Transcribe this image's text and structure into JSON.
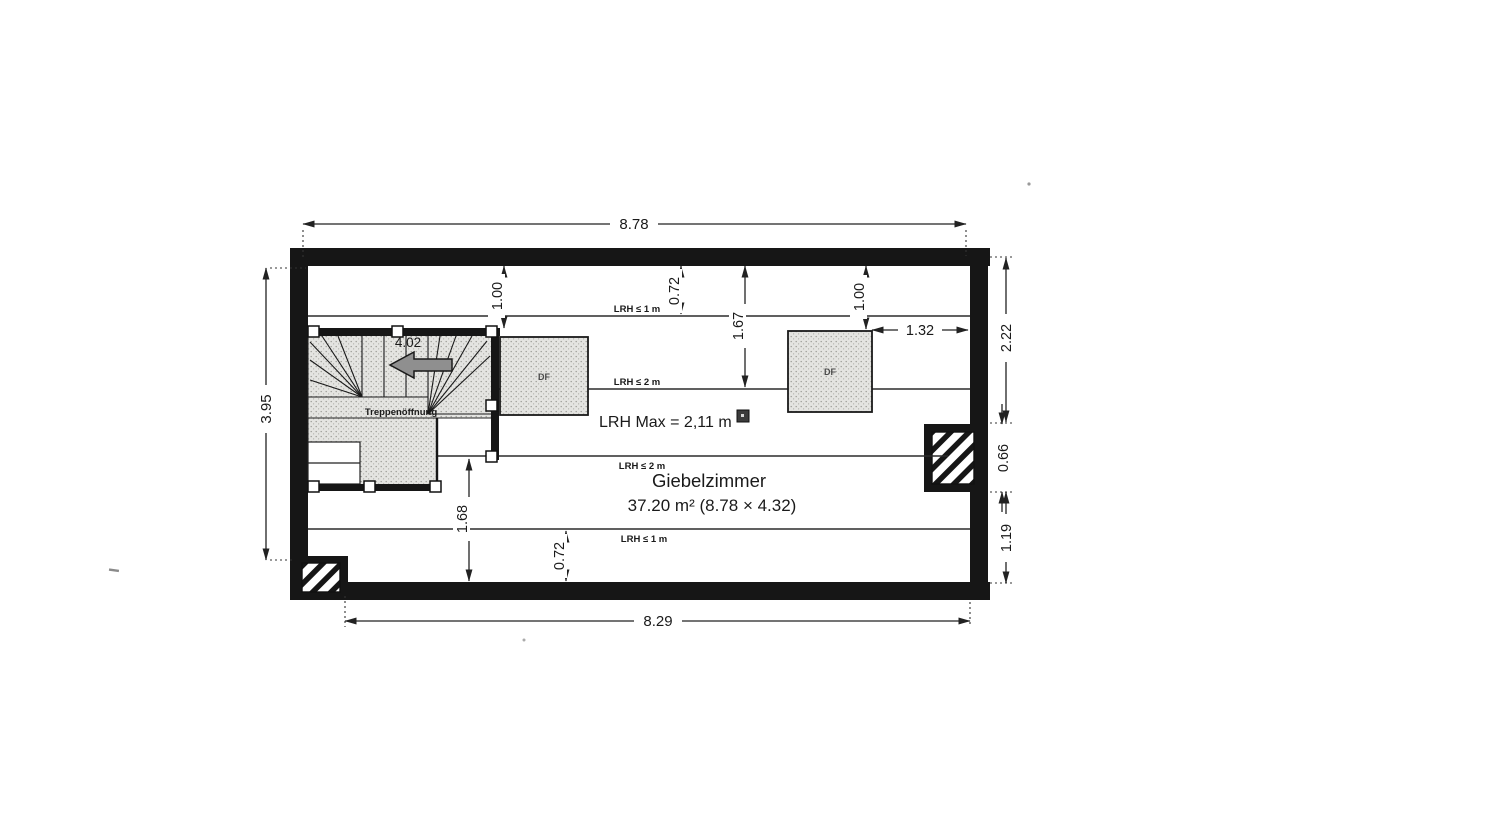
{
  "room": {
    "name": "Giebelzimmer",
    "area": "37.20 m² (8.78 × 4.32)",
    "max_clearance": "LRH Max = 2,11 m"
  },
  "clearance_lines": {
    "top_1m": "LRH ≤ 1 m",
    "top_2m": "LRH ≤ 2 m",
    "bottom_2m": "LRH ≤ 2 m",
    "bottom_1m": "LRH ≤ 1 m"
  },
  "stair": {
    "label": "Treppenöffnung",
    "dim": "4.02"
  },
  "windows": {
    "left_label": "DF",
    "right_label": "DF",
    "right_offset": "1.32"
  },
  "dimensions": {
    "overall_top": "8.78",
    "overall_bottom": "8.29",
    "overall_left": "3.95",
    "right_upper": "2.22",
    "chimney_height": "0.66",
    "right_lower": "1.19",
    "top_left_inset": "1.00",
    "top_lrh1_offset": "0.72",
    "top_lrh2_offset": "1.67",
    "top_right_inset": "1.00",
    "bottom_lrh2_offset": "1.68",
    "bottom_lrh1_offset": "0.72"
  }
}
